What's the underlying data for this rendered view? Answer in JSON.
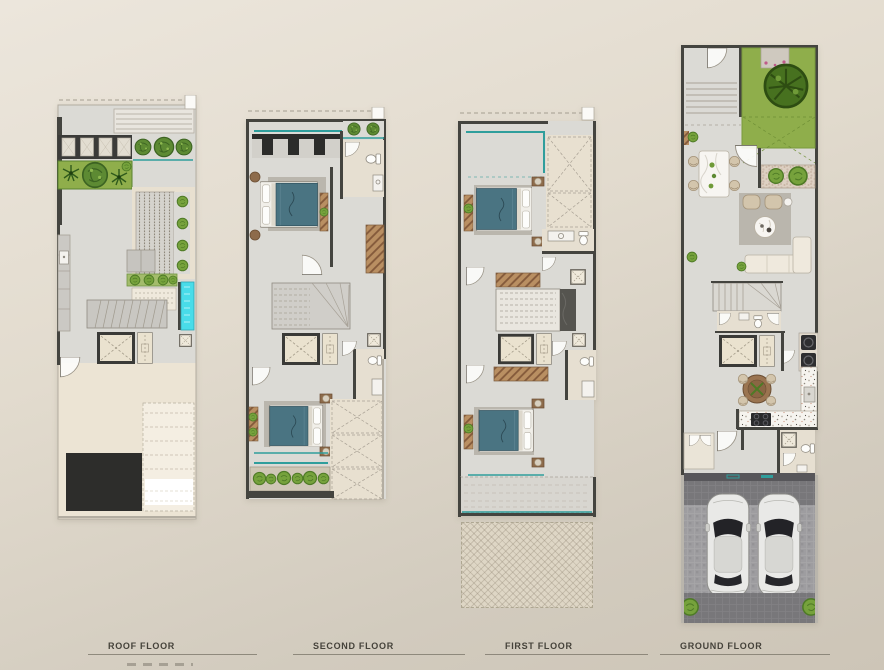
{
  "sheet": {
    "description": "Townhouse floor plan presentation sheet with four stacked-plan drawings",
    "floors": [
      {
        "id": "roof",
        "label": "ROOF FLOOR"
      },
      {
        "id": "second",
        "label": "SECOND FLOOR"
      },
      {
        "id": "first",
        "label": "FIRST FLOOR"
      },
      {
        "id": "ground",
        "label": "GROUND FLOOR"
      }
    ]
  },
  "palette": {
    "bg-top": "#ece6dc",
    "bg-bottom": "#d2cbbe",
    "wall": "#44443f",
    "floor": "#dbdad5",
    "floor-warm": "#ece4d4",
    "beige": "#e6dfd1",
    "cream": "#e8e0d0",
    "lawn": "#8fae4b",
    "leaf": "#5d8a33",
    "teal": "#2f9e9c",
    "pool": "#49dce9",
    "wood": "#8d6b4b",
    "bed": "#4a7482",
    "rug": "#bab6ad",
    "charcoal": "#2d2d2b",
    "label-text": "#45423a",
    "label-rule": "#7d786c"
  }
}
